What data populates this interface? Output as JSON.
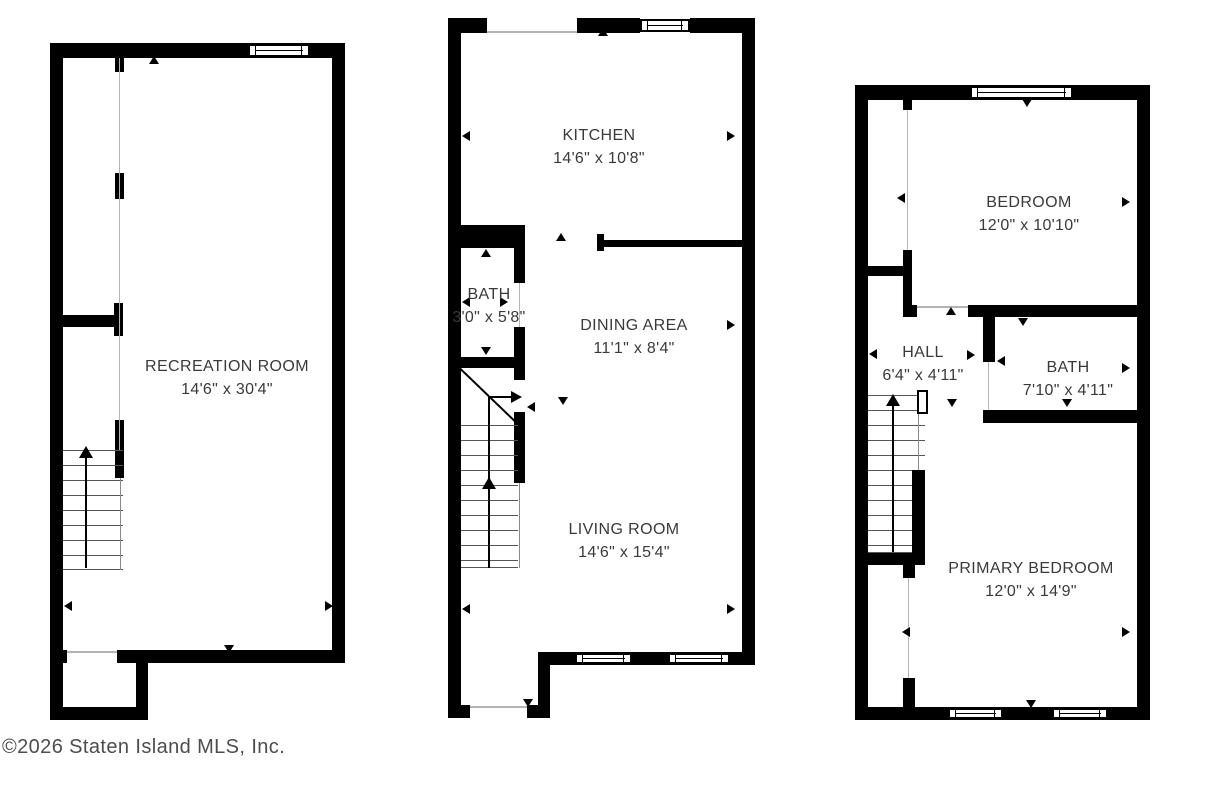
{
  "title": "Three-level townhouse floor plan",
  "colors": {
    "wall": "#000000",
    "background": "#ffffff",
    "label_text": "#3a3a3a",
    "copyright_text": "#4d4d4d"
  },
  "copyright": "©2026 Staten Island MLS, Inc.",
  "floors": [
    {
      "id": "basement-level",
      "rooms": [
        {
          "name": "RECREATION ROOM",
          "dims": "14'6\" x 30'4\""
        }
      ]
    },
    {
      "id": "main-level",
      "rooms": [
        {
          "name": "KITCHEN",
          "dims": "14'6\" x 10'8\""
        },
        {
          "name": "BATH",
          "dims": "3'0\" x 5'8\""
        },
        {
          "name": "DINING AREA",
          "dims": "11'1\" x 8'4\""
        },
        {
          "name": "LIVING ROOM",
          "dims": "14'6\" x 15'4\""
        }
      ]
    },
    {
      "id": "upper-level",
      "rooms": [
        {
          "name": "BEDROOM",
          "dims": "12'0\" x 10'10\""
        },
        {
          "name": "HALL",
          "dims": "6'4\" x 4'11\""
        },
        {
          "name": "BATH",
          "dims": "7'10\" x 4'11\""
        },
        {
          "name": "PRIMARY BEDROOM",
          "dims": "12'0\" x 14'9\""
        }
      ]
    }
  ]
}
